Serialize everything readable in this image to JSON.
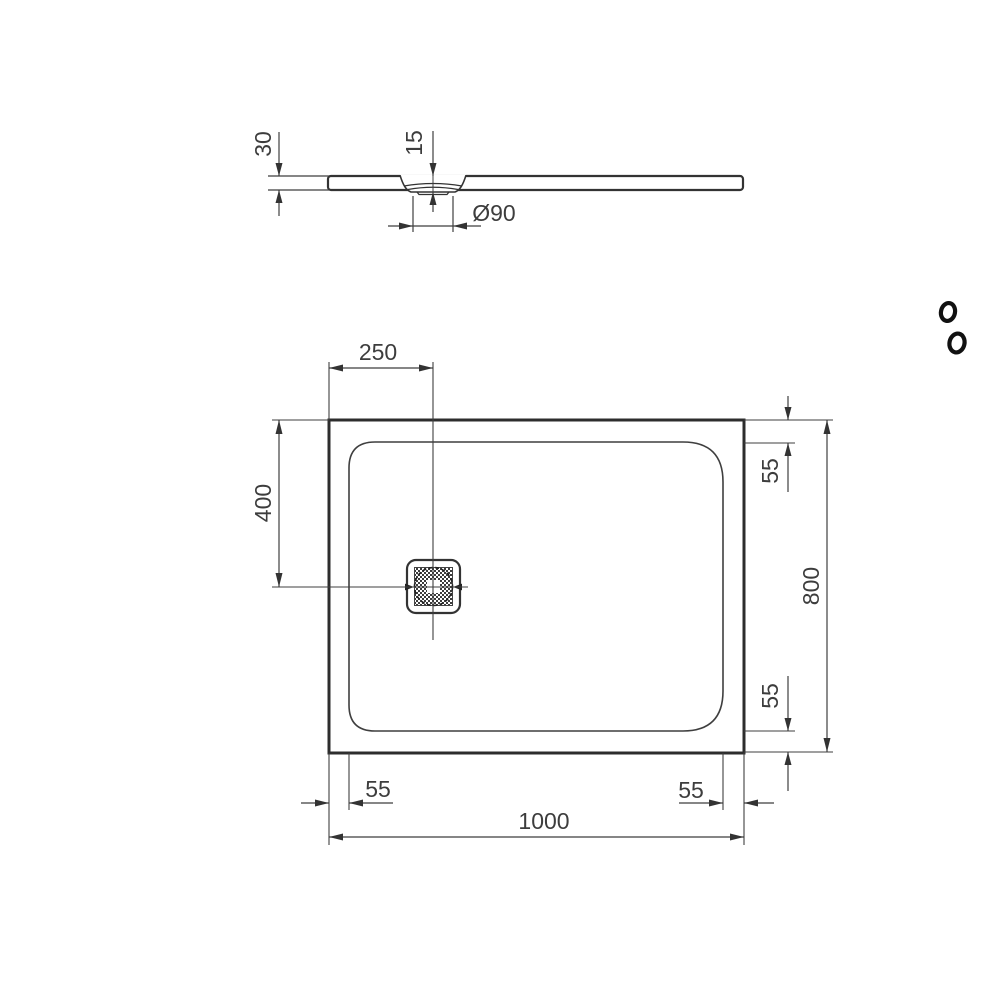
{
  "logo": {
    "name": "ideal-standard-logo-mark"
  },
  "profile_view": {
    "thickness": "30",
    "recess_depth": "15",
    "drain_diameter": "Ø90"
  },
  "plan_view": {
    "drain_offset_from_left": "250",
    "drain_offset_from_top": "400",
    "overall_length": "1000",
    "overall_width": "800",
    "rim_top": "55",
    "rim_bottom": "55",
    "rim_left": "55",
    "rim_right": "55"
  },
  "dimensions_mm": {
    "length": 1000,
    "width": 800,
    "thickness": 30,
    "recess_depth": 15,
    "drain_diameter": 90,
    "drain_offset_left": 250,
    "drain_offset_top": 400,
    "rim_inset": 55
  },
  "colors": {
    "line": "#333333",
    "thick_line": "#2d2d2d",
    "text": "#3d3d3d",
    "background": "#ffffff"
  }
}
